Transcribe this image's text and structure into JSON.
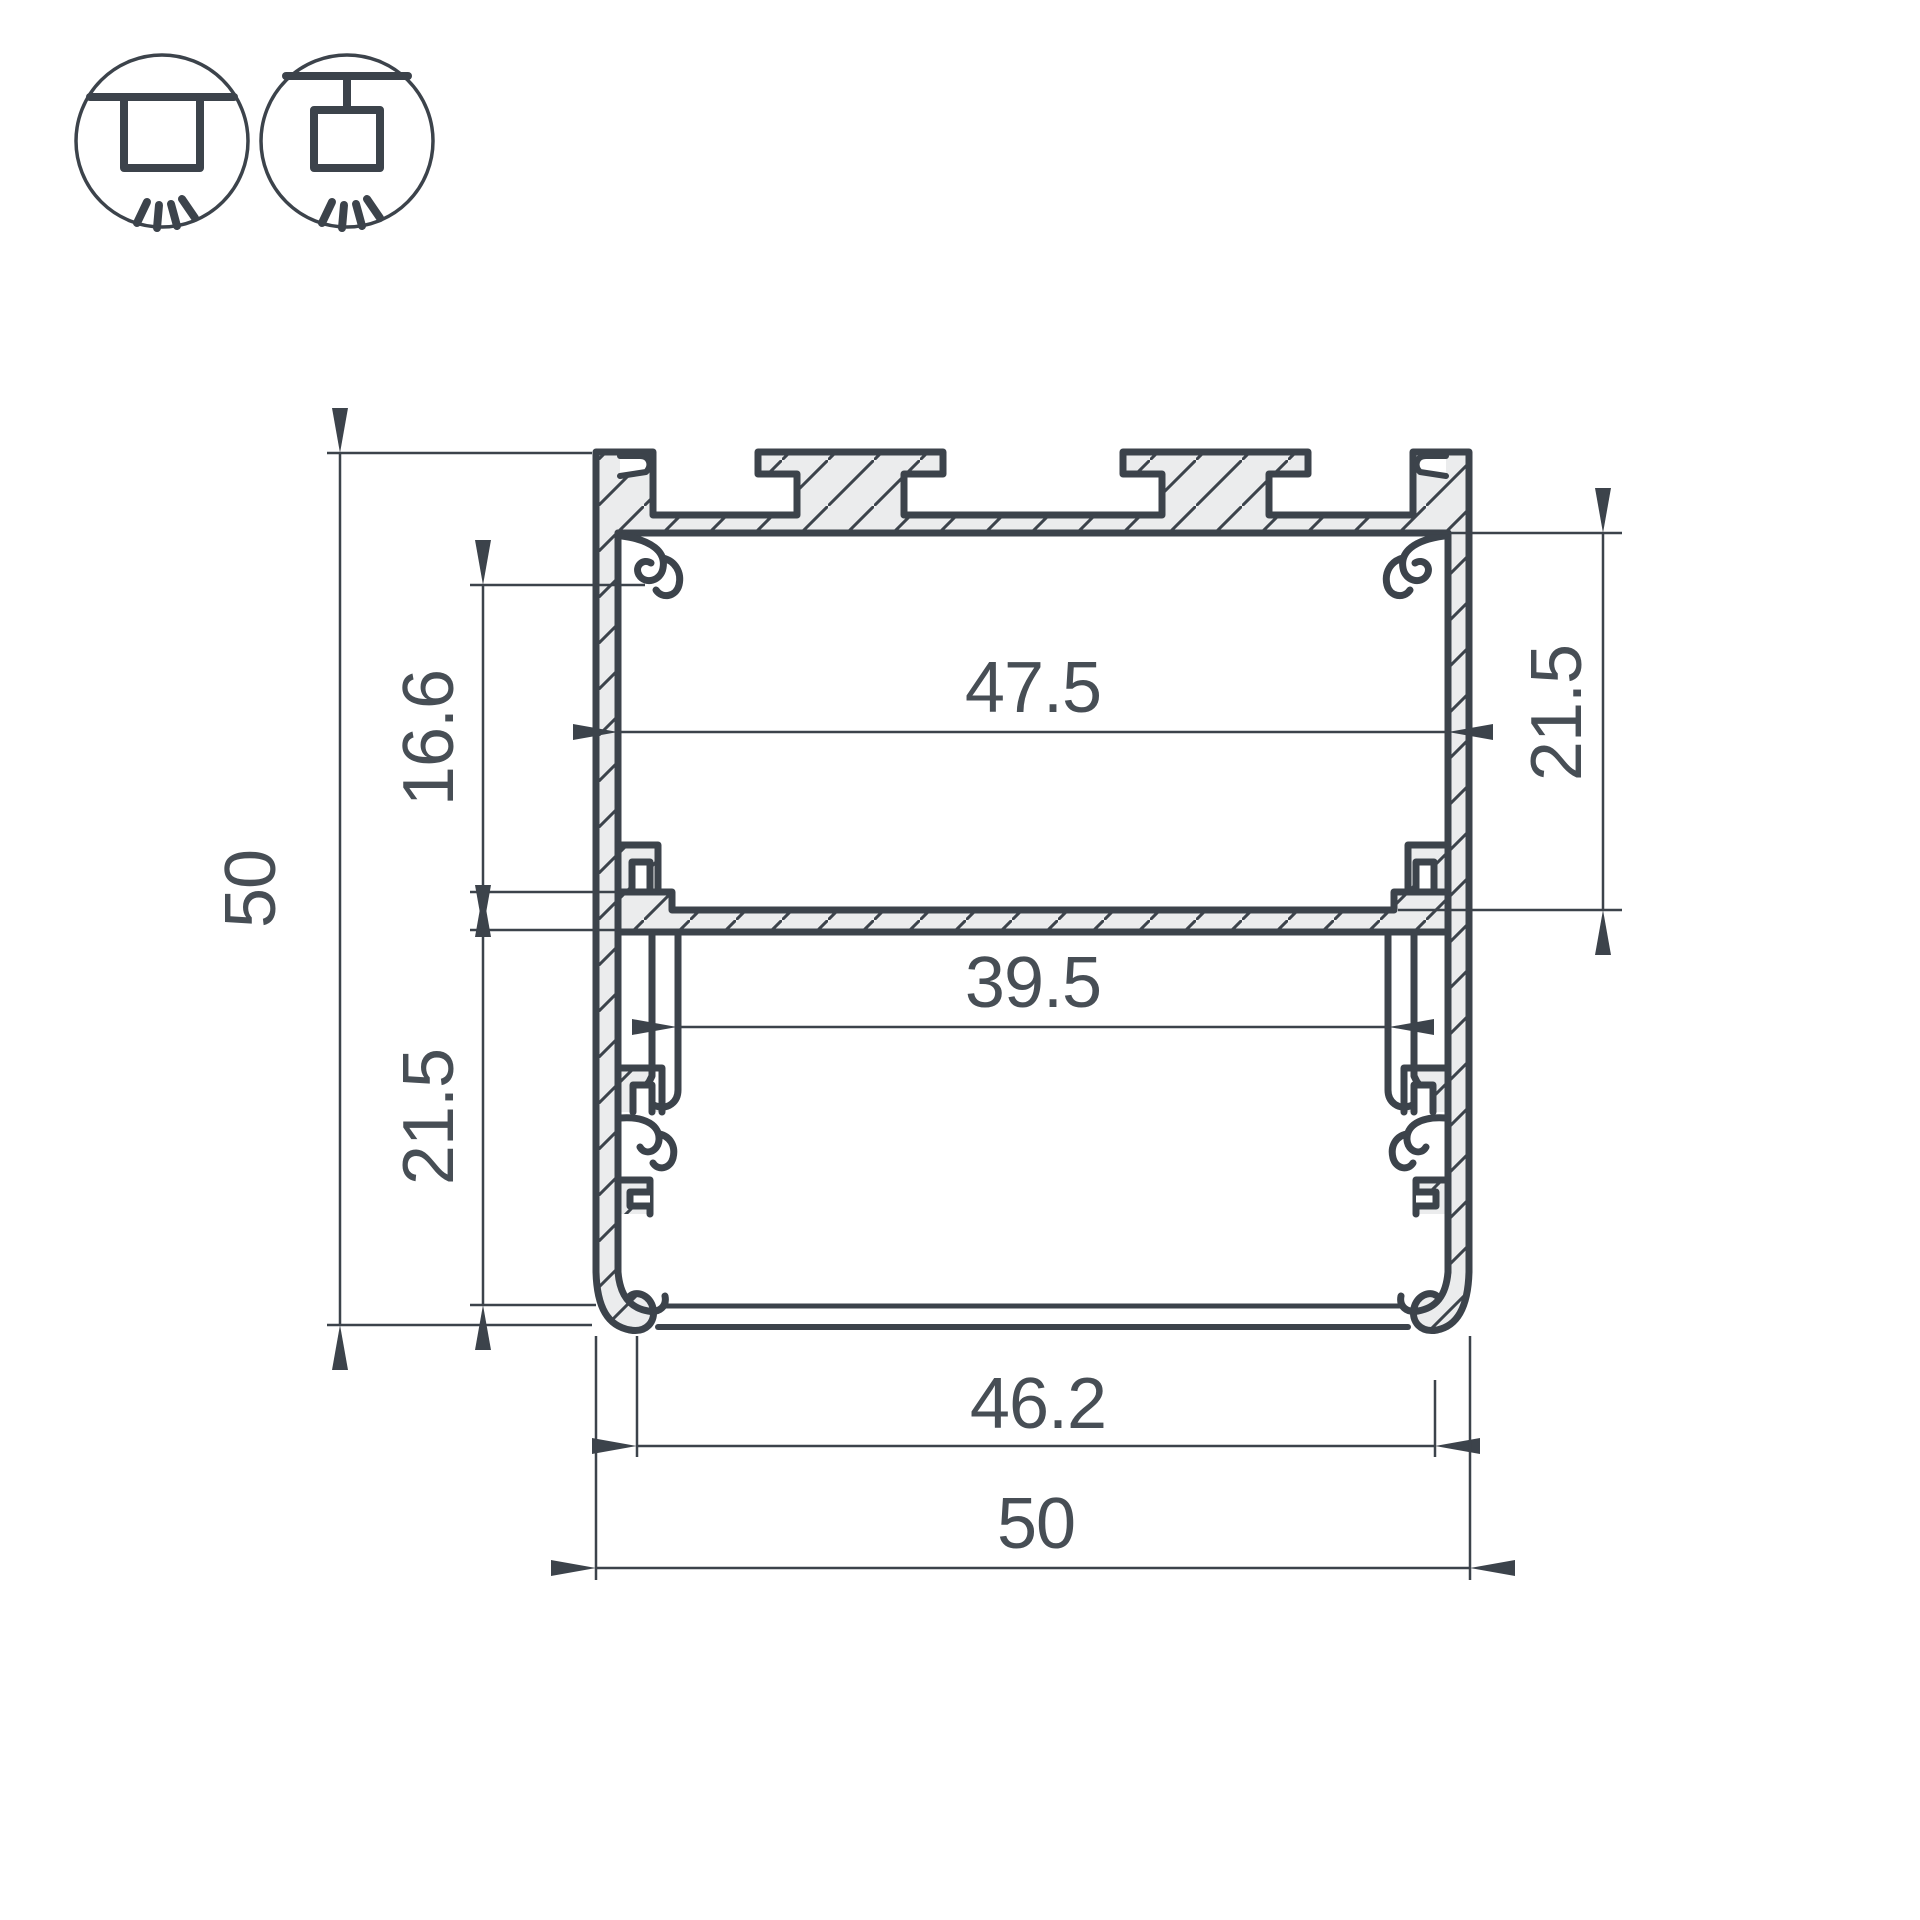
{
  "icons": {
    "left": "surface-mount-icon",
    "right": "pendant-mount-icon"
  },
  "dims": {
    "height_overall": "50",
    "boss_offset_left": "16.6",
    "lower_chamber_height_left": "21.5",
    "inner_width_top": "47.5",
    "upper_chamber_height_right": "21.5",
    "inner_width_lower": "39.5",
    "bottom_opening_width": "46.2",
    "width_overall": "50"
  },
  "colors": {
    "line": "#3c434b",
    "metal_fill": "#ebeced",
    "text": "#474e55",
    "background": "#ffffff"
  }
}
